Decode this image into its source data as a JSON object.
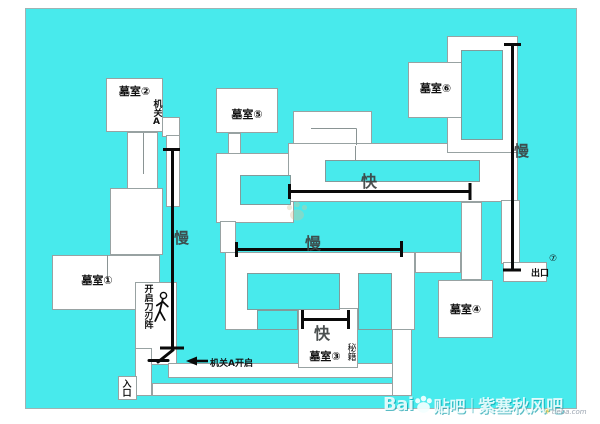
{
  "colors": {
    "map_background": "#48eaec",
    "path_white": "#ffffff",
    "route_line": "#0a0a0a",
    "outline_gray": "#98a2a2"
  },
  "rooms": {
    "r1": "墓室①",
    "r2": "墓室②",
    "r3": "墓室③",
    "r4": "墓室④",
    "r5": "墓室⑤",
    "r6": "墓室⑥"
  },
  "labels": {
    "mech_a": "机关A",
    "blade_trap": "开启刀刃阵",
    "mech_a_open": "机关A开启",
    "entrance": "入口",
    "exit": "出口",
    "exit_num": "⑦",
    "secret": "秘籍",
    "fast_mid": "快",
    "fast_room3": "快",
    "slow_left": "慢",
    "slow_right": "慢",
    "slow_mid": "慢"
  },
  "watermark": {
    "brand_prefix": "Bai",
    "brand_suffix": "贴吧",
    "divider": "|",
    "forum_name": "紫塞秋风吧",
    "site": "tieba.com"
  }
}
